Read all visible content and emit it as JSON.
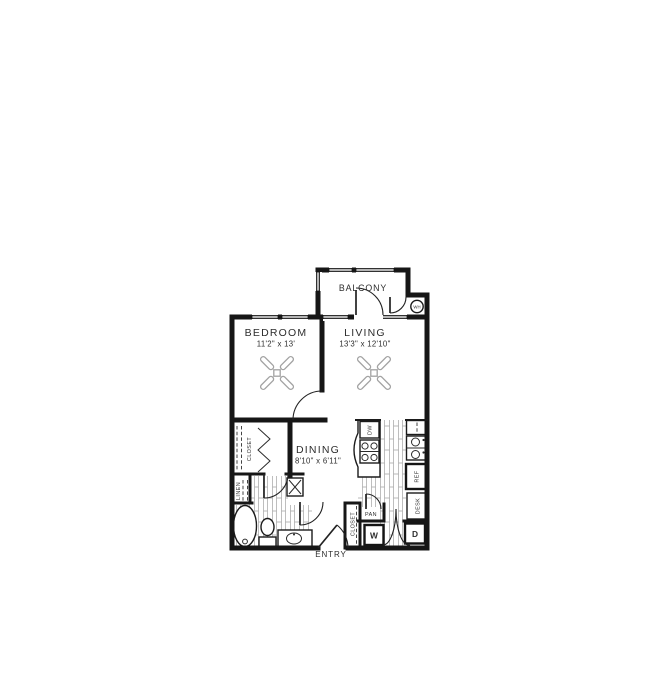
{
  "canvas": {
    "width": 650,
    "height": 700,
    "background": "#ffffff"
  },
  "colors": {
    "wall": "#161616",
    "window_glass": "#b5b5b5",
    "plank_hatch": "#a3a3a3",
    "ceiling_fan": "#a2a2a2",
    "text": "#2d2d2d"
  },
  "rooms": {
    "balcony": {
      "name": "BALCONY"
    },
    "bedroom": {
      "name": "BEDROOM",
      "dims": "11'2\" x 13'"
    },
    "living": {
      "name": "LIVING",
      "dims": "13'3\" x 12'10\""
    },
    "dining": {
      "name": "DINING",
      "dims": "8'10\" x 6'11\""
    },
    "entry": {
      "name": "ENTRY"
    }
  },
  "closets": {
    "bedroom_closet": "CLOSET",
    "linen": "LINEN",
    "entry_closet": "CLOSET",
    "pantry": "PAN"
  },
  "appliances": {
    "washer": "W",
    "dryer": "D",
    "dishwasher": "DW",
    "refrigerator": "REF",
    "desk": "DESK",
    "water_heater": "WH"
  }
}
